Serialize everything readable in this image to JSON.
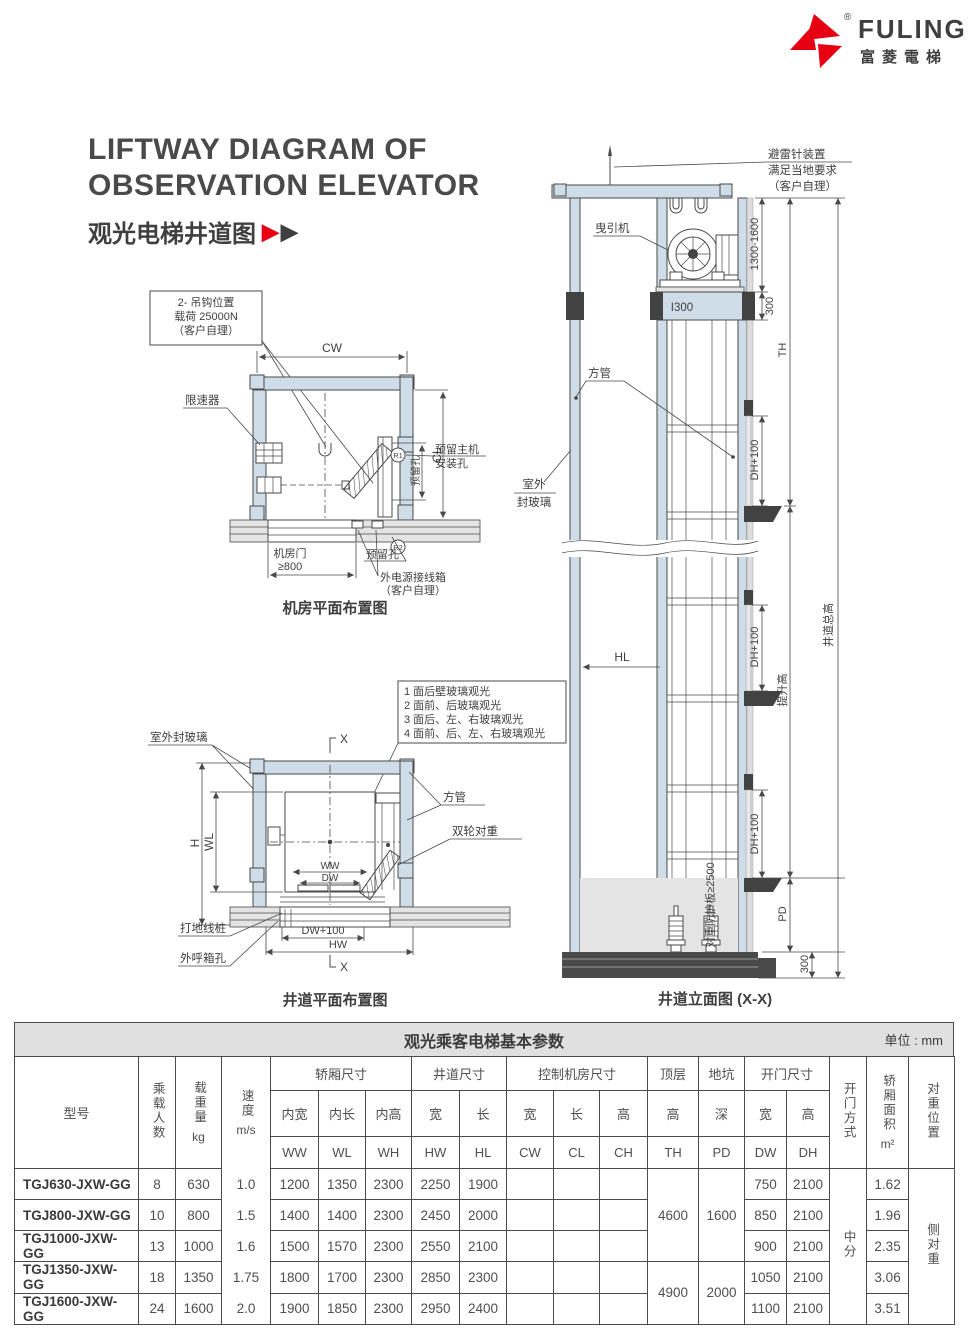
{
  "logo": {
    "brand": "FULING",
    "brand_cn": "富菱電梯",
    "registered": "®",
    "red": "#e60012"
  },
  "title": {
    "en1": "LIFTWAY DIAGRAM OF",
    "en2": "OBSERVATION ELEVATOR",
    "cn": "观光电梯井道图",
    "arrow": "▶"
  },
  "machine_room": {
    "hook_callout1": "2- 吊钩位置",
    "hook_callout2": "载荷 25000N",
    "hook_callout3": "（客户自理）",
    "dim_cw": "CW",
    "dim_cl": "CL",
    "governor": "限速器",
    "reserved_hole": "预留孔",
    "main_machine1": "预留主机",
    "main_machine2": "安装孔",
    "r1": "R1",
    "r2": "R2",
    "door1": "机房门",
    "door2": "≥800",
    "power1": "外电源接线箱",
    "power2": "（客户自理）",
    "caption": "机房平面布置图"
  },
  "liftway_plan": {
    "glass": "室外封玻璃",
    "note1": "1 面后壁玻璃观光",
    "note2": "2 面前、后玻璃观光",
    "note3": "3 面后、左、右玻璃观光",
    "note4": "4 面前、后、左、右玻璃观光",
    "tube": "方管",
    "cw": "双轮对重",
    "dim_h": "H",
    "dim_wl": "WL",
    "dim_ww": "WW",
    "dim_dw": "DW",
    "dim_dw100": "DW+100",
    "dim_hw": "HW",
    "peg": "打地线桩",
    "callbox": "外呼箱孔",
    "x": "X",
    "caption": "井道平面布置图"
  },
  "elevation": {
    "lightning1": "避雷针装置",
    "lightning2": "满足当地要求",
    "lightning3": "（客户自理）",
    "machine": "曳引机",
    "beam": "I300",
    "tube": "方管",
    "glass1": "室外",
    "glass2": "封玻璃",
    "dim_a": "1300-1600",
    "dim_b": "300",
    "dim_dh": "DH+100",
    "dim_th": "TH",
    "dim_hl": "HL",
    "lift_height": "提升高",
    "total_height": "井道总高",
    "guard": "对重防护板≥2500",
    "dim_pd": "PD",
    "caption": "井道立面图 (X-X)"
  },
  "table": {
    "title": "观光乘客电梯基本参数",
    "unit": "单位 : mm",
    "h_model": "型号",
    "h_persons": "乘载人数",
    "h_load": "载重量",
    "h_load_u": "kg",
    "h_speed": "速度",
    "h_speed_u": "m/s",
    "g_car": "轿厢尺寸",
    "g_shaft": "井道尺寸",
    "g_ctrl": "控制机房尺寸",
    "g_top": "顶层",
    "g_pit": "地坑",
    "g_door": "开门尺寸",
    "h_door_mode": "开门方式",
    "h_area": "轿厢面积",
    "h_area_u": "m²",
    "h_cwpos": "对重位置",
    "s_ww": "内宽",
    "s_wl": "内长",
    "s_wh": "内高",
    "s_w": "宽",
    "s_l": "长",
    "s_h": "高",
    "s_d": "深",
    "c_ww": "WW",
    "c_wl": "WL",
    "c_wh": "WH",
    "c_hw": "HW",
    "c_hl": "HL",
    "c_cw": "CW",
    "c_cl": "CL",
    "c_ch": "CH",
    "c_th": "TH",
    "c_pd": "PD",
    "c_dw": "DW",
    "c_dh": "DH",
    "rows": [
      {
        "model": "TGJ630-JXW-GG",
        "persons": "8",
        "load": "630",
        "speed": "1.0",
        "ww": "1200",
        "wl": "1350",
        "wh": "2300",
        "hw": "2250",
        "hl": "1900",
        "dw": "750",
        "dh": "2100",
        "area": "1.62"
      },
      {
        "model": "TGJ800-JXW-GG",
        "persons": "10",
        "load": "800",
        "speed": "1.5",
        "ww": "1400",
        "wl": "1400",
        "wh": "2300",
        "hw": "2450",
        "hl": "2000",
        "dw": "850",
        "dh": "2100",
        "area": "1.96"
      },
      {
        "model": "TGJ1000-JXW-GG",
        "persons": "13",
        "load": "1000",
        "speed": "1.6",
        "ww": "1500",
        "wl": "1570",
        "wh": "2300",
        "hw": "2550",
        "hl": "2100",
        "dw": "900",
        "dh": "2100",
        "area": "2.35"
      },
      {
        "model": "TGJ1350-JXW-GG",
        "persons": "18",
        "load": "1350",
        "speed": "1.75",
        "ww": "1800",
        "wl": "1700",
        "wh": "2300",
        "hw": "2850",
        "hl": "2300",
        "dw": "1050",
        "dh": "2100",
        "area": "3.06"
      },
      {
        "model": "TGJ1600-JXW-GG",
        "persons": "24",
        "load": "1600",
        "speed": "2.0",
        "ww": "1900",
        "wl": "1850",
        "wh": "2300",
        "hw": "2950",
        "hl": "2400",
        "dw": "1100",
        "dh": "2100",
        "area": "3.51"
      }
    ],
    "th_a": "4600",
    "th_b": "4900",
    "pd_a": "1600",
    "pd_b": "2000",
    "door_mode": "中分",
    "cw_pos": "侧对重"
  }
}
